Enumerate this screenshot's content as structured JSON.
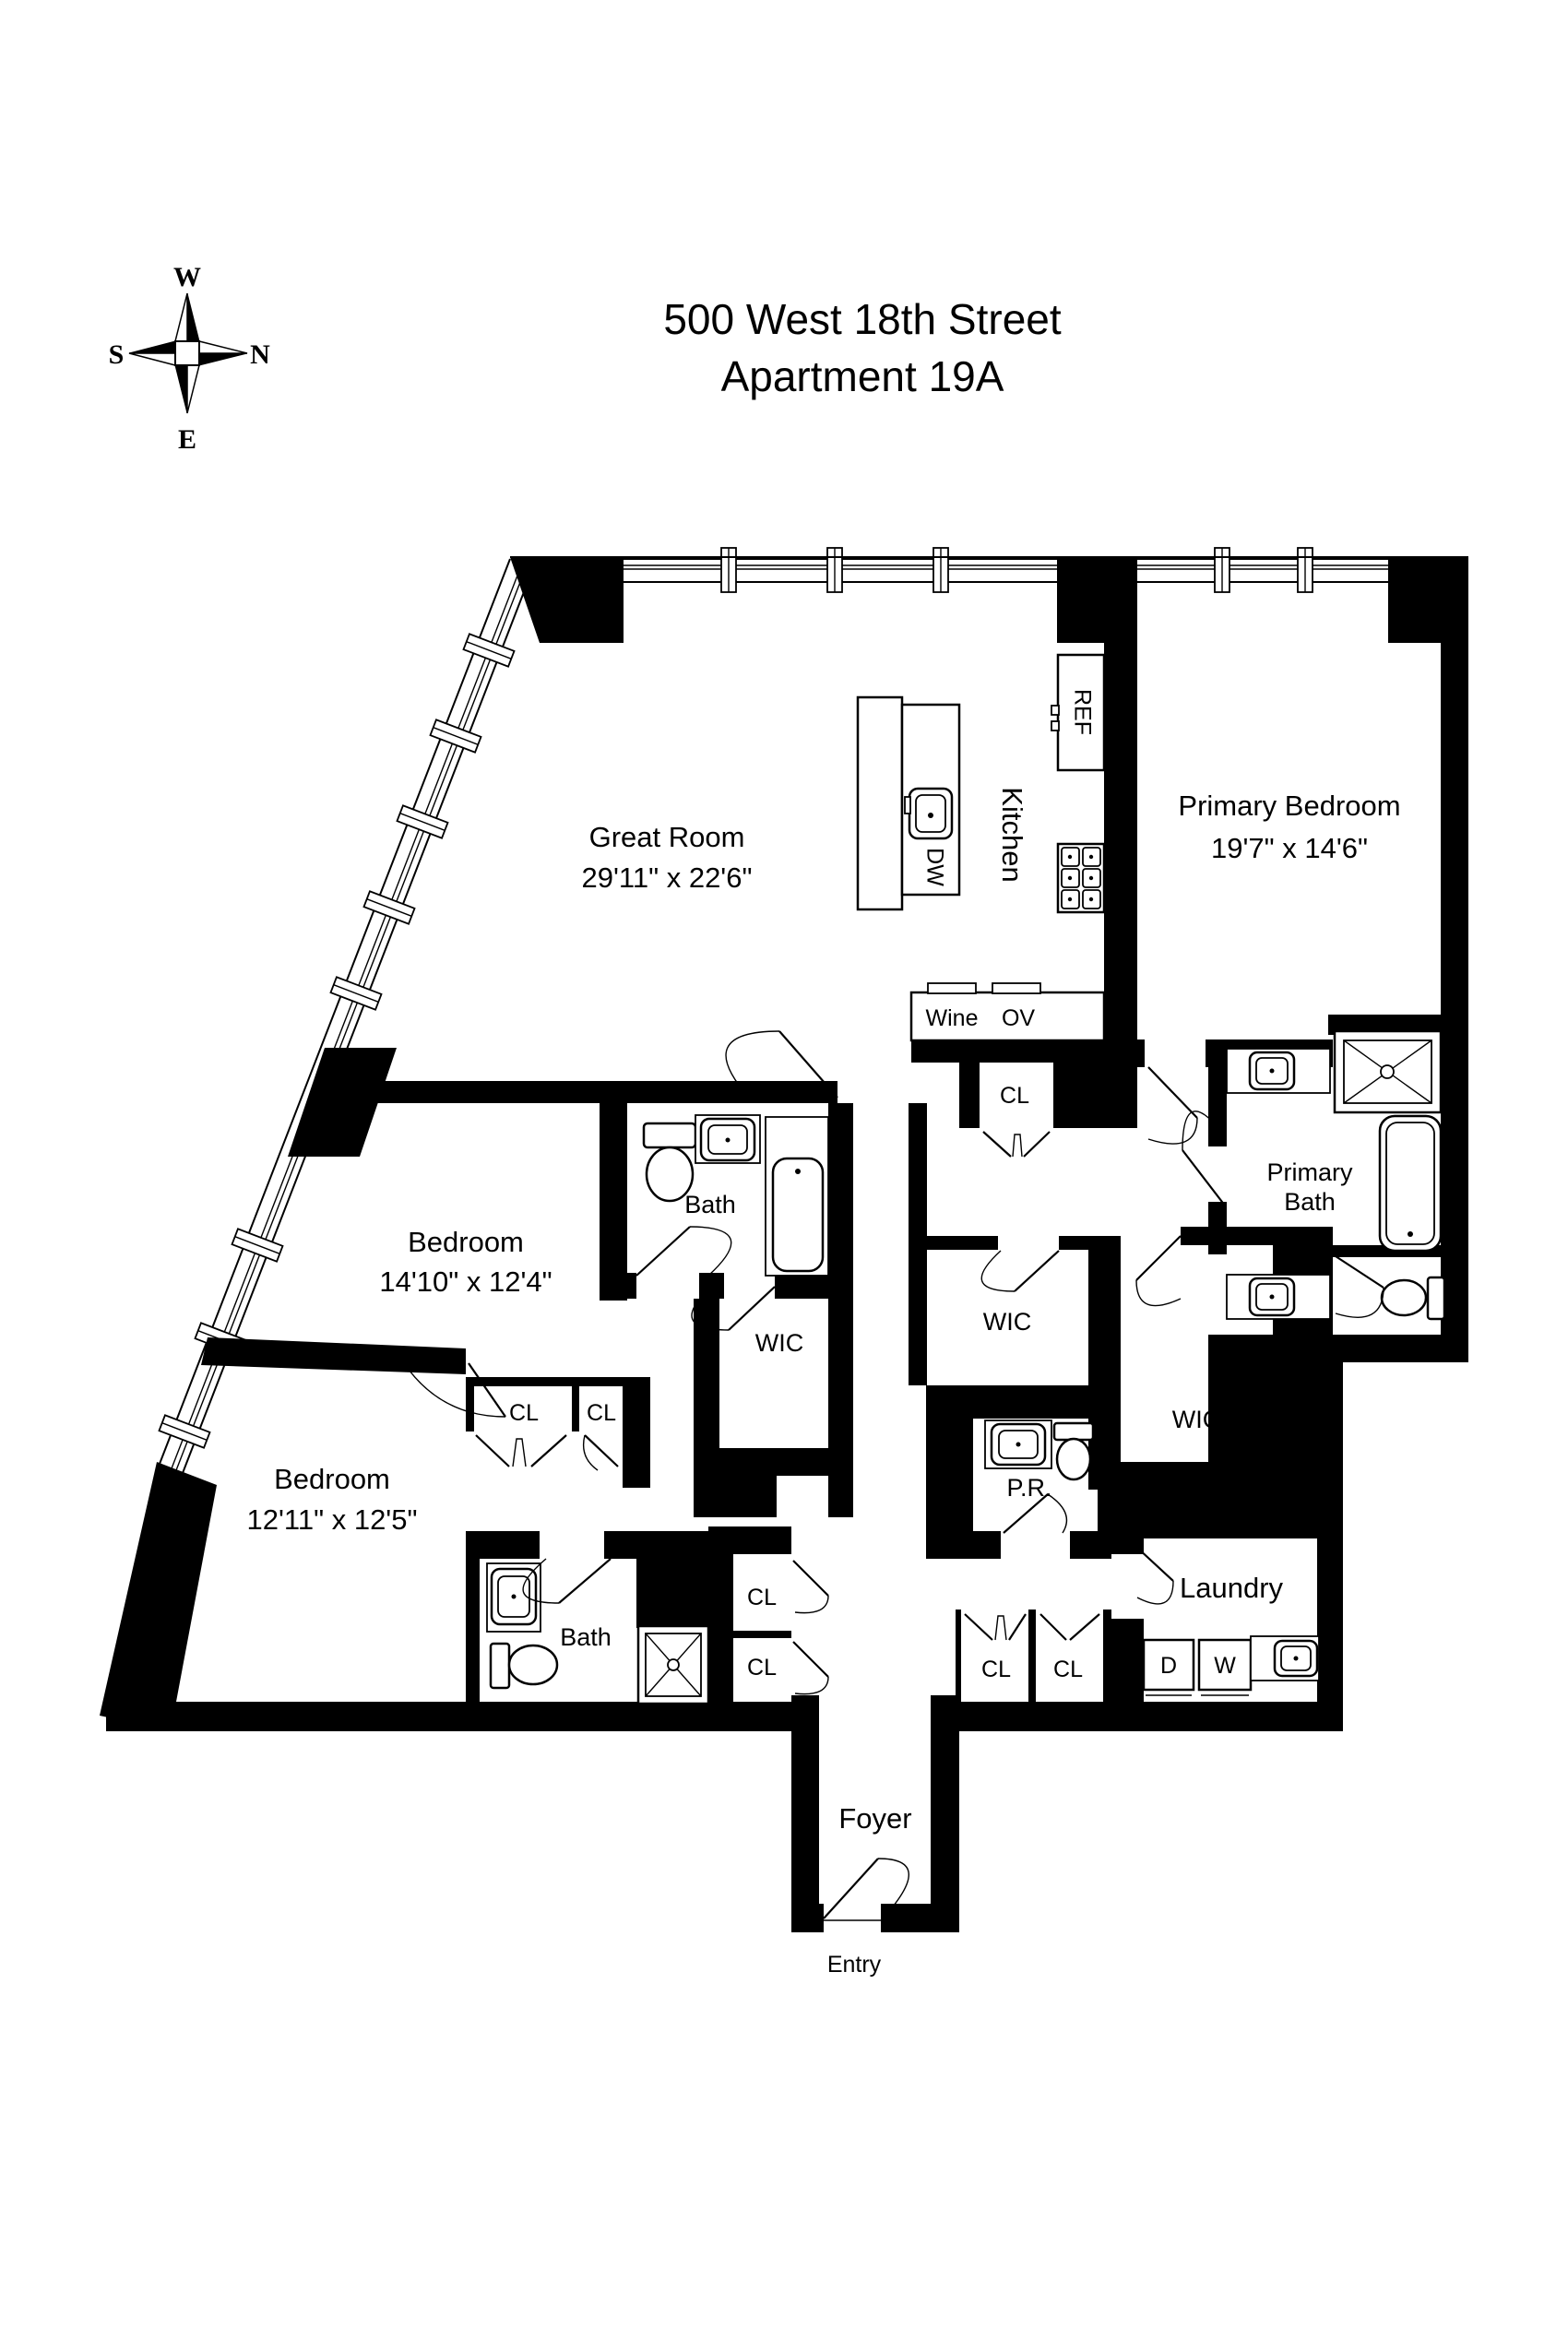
{
  "title": {
    "line1": "500 West 18th Street",
    "line2": "Apartment 19A"
  },
  "compass": {
    "top": "W",
    "left": "S",
    "right": "N",
    "bottom": "E"
  },
  "rooms": {
    "great_room": {
      "name": "Great Room",
      "dims": "29'11\" x 22'6\""
    },
    "kitchen": {
      "name": "Kitchen"
    },
    "primary_bedroom": {
      "name": "Primary Bedroom",
      "dims": "19'7\" x 14'6\""
    },
    "primary_bath": {
      "line1": "Primary",
      "line2": "Bath"
    },
    "bedroom_mid": {
      "name": "Bedroom",
      "dims": "14'10\" x 12'4\""
    },
    "bedroom_lower": {
      "name": "Bedroom",
      "dims": "12'11\" x 12'5\""
    },
    "bath": {
      "name": "Bath"
    },
    "powder_room": {
      "name": "P.R."
    },
    "laundry": {
      "name": "Laundry"
    },
    "foyer": {
      "name": "Foyer"
    },
    "entry": {
      "name": "Entry"
    },
    "walk_in_closet": {
      "name": "WIC"
    },
    "closet": {
      "name": "CL"
    }
  },
  "appliances": {
    "refrigerator": "REF",
    "dishwasher": "DW",
    "wine_cooler": "Wine",
    "oven": "OV",
    "dryer": "D",
    "washer": "W"
  },
  "colors": {
    "walls": "#000000",
    "background": "#ffffff"
  }
}
